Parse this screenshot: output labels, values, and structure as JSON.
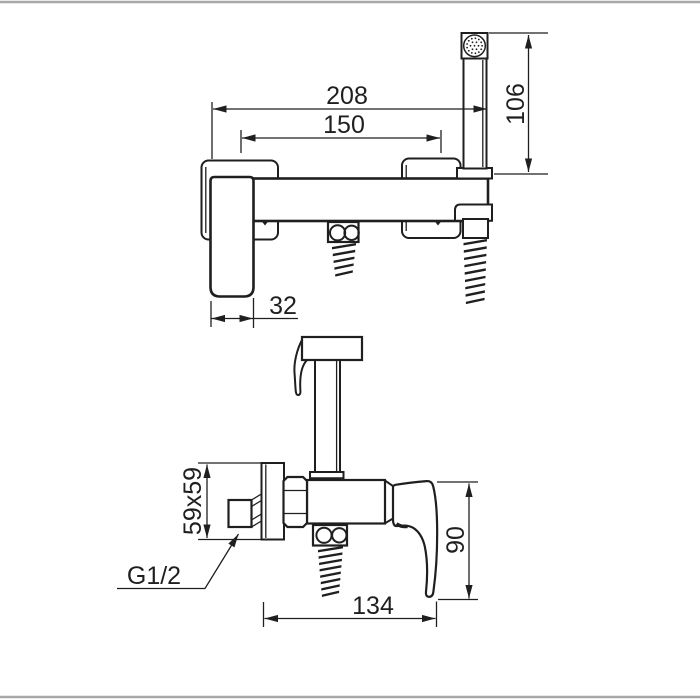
{
  "page": {
    "background": "#ffffff",
    "divider_color": "#a8a8a8",
    "line_color": "#1f1f1f"
  },
  "views": {
    "front": {
      "dims": {
        "overall_width": "208",
        "hose_centers": "150",
        "handshower_height": "106",
        "handle_width": "32"
      }
    },
    "side": {
      "dims": {
        "flange_size": "59x59",
        "thread_label": "G1/2",
        "handle_drop": "90",
        "depth": "134"
      }
    }
  }
}
